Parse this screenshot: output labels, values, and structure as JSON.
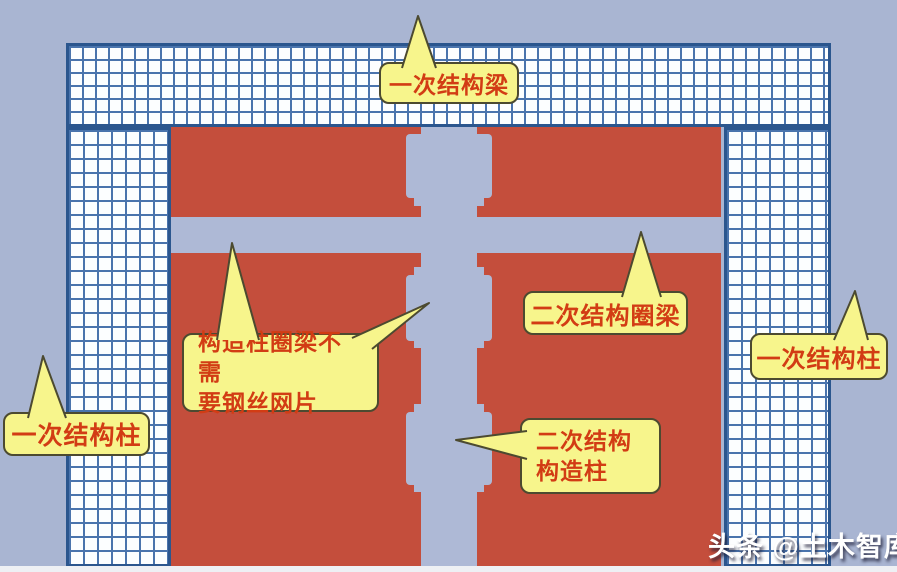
{
  "diagram": {
    "title_hint": "二次结构施工示意图",
    "callouts": {
      "primary_beam": "一次结构梁",
      "primary_column_left": "一次结构柱",
      "primary_column_right": "一次结构柱",
      "secondary_ring_beam": "二次结构圈梁",
      "mesh_note_line1": "构造柱圈梁不需",
      "mesh_note_line2": "要钢丝网片",
      "secondary_column_line1": "二次结构",
      "secondary_column_line2": "构造柱"
    },
    "watermark": "头条 @土木智库"
  },
  "colors": {
    "background": "#a9b5d2",
    "masonry_red": "#c44e3c",
    "concrete_blue": "#aeb9d6",
    "mesh_bg": "#fcfeff",
    "mesh_line": "#4a74ad",
    "mesh_border": "#2b568e",
    "callout_fill": "#f7f58c",
    "callout_border": "#4c4a30",
    "callout_text": "#d23c14",
    "watermark_color": "#ffffff",
    "footer_strip": "#eef0f4"
  }
}
